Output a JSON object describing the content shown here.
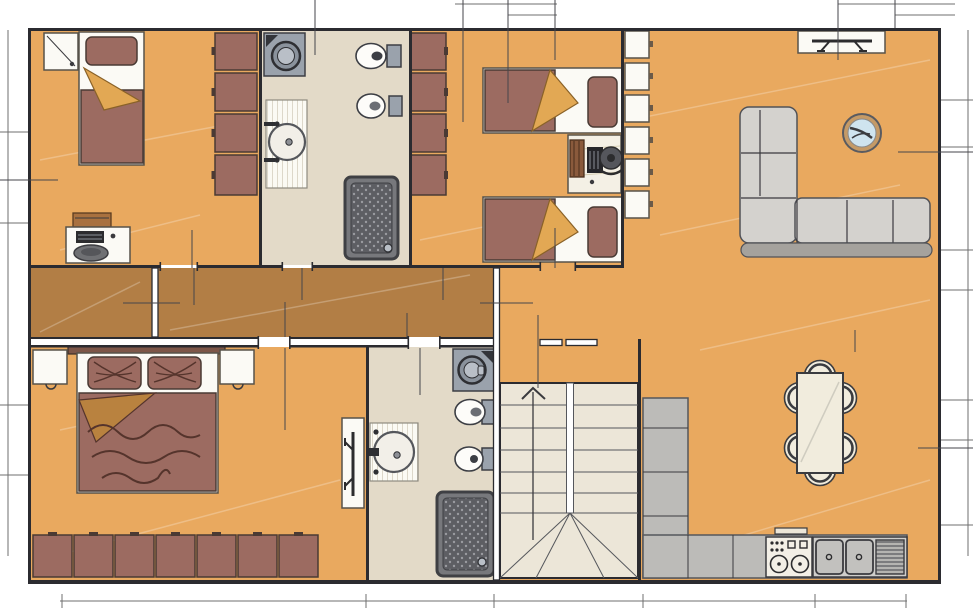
{
  "meta": {
    "type": "architectural-floor-plan",
    "width_px": 973,
    "height_px": 608,
    "visible_text": ""
  },
  "colors": {
    "background": "#ffffff",
    "floor_main": "#e9a95f",
    "floor_corridor": "#b27e45",
    "floor_bathroom": "#e3dac8",
    "floor_stairs": "#ece6d8",
    "wall": "#2b2b30",
    "furniture_brick": "#9c6b61",
    "furniture_cream": "#f4f0e5",
    "fold_tan": "#e2a854",
    "sofa_gray": "#d4d2ce",
    "sofa_rail_gray": "#a5a29d",
    "counter_gray": "#bcbbb8",
    "appliance_gray": "#9aa2ac",
    "shower_dark": "#5d5e63",
    "shower_frame": "#3f4044",
    "glass_blue": "#cfe4ef",
    "wood_brown": "#a9713f",
    "dim_line": "#6f6f6f",
    "extension_line": "#46464b"
  },
  "rooms": [
    {
      "id": "bedroom-1",
      "position": "top-left",
      "floor": "floor_main",
      "furniture": [
        {
          "name": "single-bed",
          "count": 1
        },
        {
          "name": "pillow",
          "count": 1
        },
        {
          "name": "nightstand",
          "count": 1
        },
        {
          "name": "wardrobe-unit",
          "count": 4
        },
        {
          "name": "desk",
          "count": 1
        },
        {
          "name": "laptop",
          "count": 1
        },
        {
          "name": "desk-chair",
          "count": 1
        },
        {
          "name": "wall-shelf",
          "count": 1
        }
      ]
    },
    {
      "id": "bathroom-1",
      "position": "top-center",
      "floor": "floor_bathroom",
      "furniture": [
        {
          "name": "washing-machine",
          "count": 1
        },
        {
          "name": "washbasin-counter",
          "count": 1
        },
        {
          "name": "toilet",
          "count": 1
        },
        {
          "name": "bidet",
          "count": 1
        },
        {
          "name": "shower-tray",
          "count": 1
        }
      ]
    },
    {
      "id": "bedroom-2",
      "position": "top-middle-right",
      "floor": "floor_main",
      "furniture": [
        {
          "name": "wardrobe-unit",
          "count": 4
        },
        {
          "name": "single-bed",
          "count": 2
        },
        {
          "name": "desk",
          "count": 1
        },
        {
          "name": "desk-chair",
          "count": 1
        },
        {
          "name": "books",
          "count": 1
        },
        {
          "name": "keyboard",
          "count": 1
        }
      ]
    },
    {
      "id": "living-room",
      "position": "top-right",
      "floor": "floor_main",
      "furniture": [
        {
          "name": "shelving-unit",
          "count": 6
        },
        {
          "name": "tv-stand",
          "count": 1
        },
        {
          "name": "corner-sofa",
          "count": 1
        },
        {
          "name": "round-side-table",
          "count": 1
        }
      ]
    },
    {
      "id": "corridor",
      "position": "middle-left",
      "floor": "floor_corridor",
      "furniture": []
    },
    {
      "id": "bedroom-3",
      "position": "bottom-left",
      "floor": "floor_main",
      "furniture": [
        {
          "name": "double-bed",
          "count": 1
        },
        {
          "name": "pillow",
          "count": 2
        },
        {
          "name": "nightstand",
          "count": 2
        },
        {
          "name": "wardrobe-unit",
          "count": 7
        },
        {
          "name": "tv-stand",
          "count": 1
        }
      ]
    },
    {
      "id": "bathroom-2",
      "position": "bottom-center",
      "floor": "floor_bathroom",
      "furniture": [
        {
          "name": "washing-machine",
          "count": 1
        },
        {
          "name": "washbasin-counter",
          "count": 1
        },
        {
          "name": "toilet",
          "count": 1
        },
        {
          "name": "bidet",
          "count": 1
        },
        {
          "name": "shower-tray",
          "count": 1
        }
      ]
    },
    {
      "id": "staircase",
      "position": "bottom-center-right",
      "floor": "floor_stairs",
      "furniture": [
        {
          "name": "stair-flight",
          "count": 2
        },
        {
          "name": "direction-arrow",
          "count": 1
        },
        {
          "name": "handrail",
          "count": 2
        }
      ]
    },
    {
      "id": "kitchen-dining",
      "position": "bottom-right",
      "floor": "floor_main",
      "furniture": [
        {
          "name": "l-shaped-counter",
          "count": 1
        },
        {
          "name": "stove",
          "count": 1
        },
        {
          "name": "sink-basin",
          "count": 2
        },
        {
          "name": "drainer",
          "count": 1
        },
        {
          "name": "dining-table",
          "count": 1
        },
        {
          "name": "dining-chair",
          "count": 6
        }
      ]
    }
  ]
}
